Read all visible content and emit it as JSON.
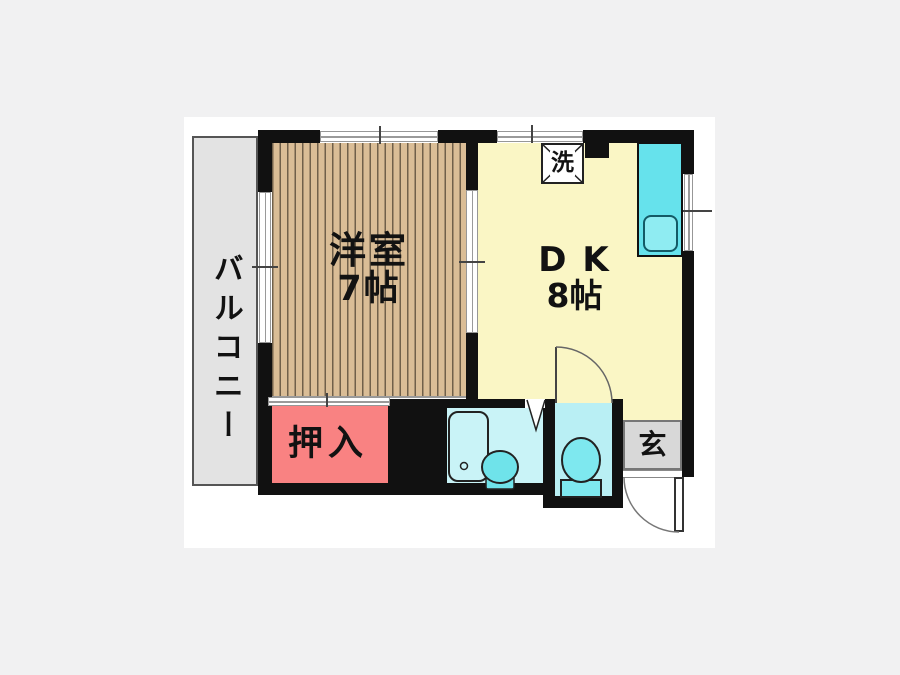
{
  "floorplan": {
    "balcony": {
      "label": "バルコニー"
    },
    "western_room": {
      "label": "洋室",
      "size": "7帖"
    },
    "dining_kitchen": {
      "label": "D K",
      "size": "8帖"
    },
    "closet": {
      "label": "押入"
    },
    "entrance": {
      "label": "玄"
    },
    "laundry_symbol": {
      "label": "洗"
    },
    "colors": {
      "wall": "#111111",
      "wood_floor": "#dabd96",
      "wood_stripe": "#70604a",
      "dk_floor": "#faf6c5",
      "closet_fill": "#f98282",
      "balcony_fill": "#e3e3e3",
      "entrance_fill": "#d8d8d8",
      "bathroom_fill": "#c9f3f7",
      "toilet_room_fill": "#b9eff4",
      "fixture_cyan": "#7ee8ef",
      "kitchen_counter": "#66e2ec",
      "page_background": "#f1f1f2",
      "plan_background": "#ffffff"
    }
  }
}
